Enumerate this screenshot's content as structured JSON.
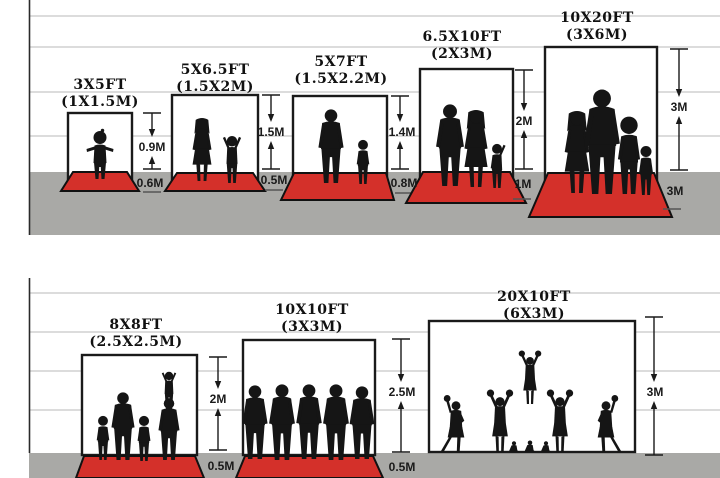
{
  "colors": {
    "carpet_red": "#d4302a",
    "ground_gray": "#a9a9a6",
    "gridline": "#c8c8c8",
    "ink": "#1a1a1a",
    "silhouette": "#151515",
    "backdrop_white": "#ffffff"
  },
  "rows": [
    {
      "panels": [
        {
          "size_ft": "3X5FT",
          "size_m": "(1X1.5M)",
          "height_label": "0.9M",
          "depth_label": "0.6M"
        },
        {
          "size_ft": "5X6.5FT",
          "size_m": "(1.5X2M)",
          "height_label": "1.5M",
          "depth_label": "0.5M"
        },
        {
          "size_ft": "5X7FT",
          "size_m": "(1.5X2.2M)",
          "height_label": "1.4M",
          "depth_label": "0.8M"
        },
        {
          "size_ft": "6.5X10FT",
          "size_m": "(2X3M)",
          "height_label": "2M",
          "depth_label": "1M"
        },
        {
          "size_ft": "10X20FT",
          "size_m": "(3X6M)",
          "height_label": "3M",
          "depth_label": "3M"
        }
      ]
    },
    {
      "panels": [
        {
          "size_ft": "8X8FT",
          "size_m": "(2.5X2.5M)",
          "height_label": "2M",
          "depth_label": "0.5M"
        },
        {
          "size_ft": "10X10FT",
          "size_m": "(3X3M)",
          "height_label": "2.5M",
          "depth_label": "0.5M"
        },
        {
          "size_ft": "20X10FT",
          "size_m": "(6X3M)",
          "height_label": "3M"
        }
      ]
    }
  ]
}
